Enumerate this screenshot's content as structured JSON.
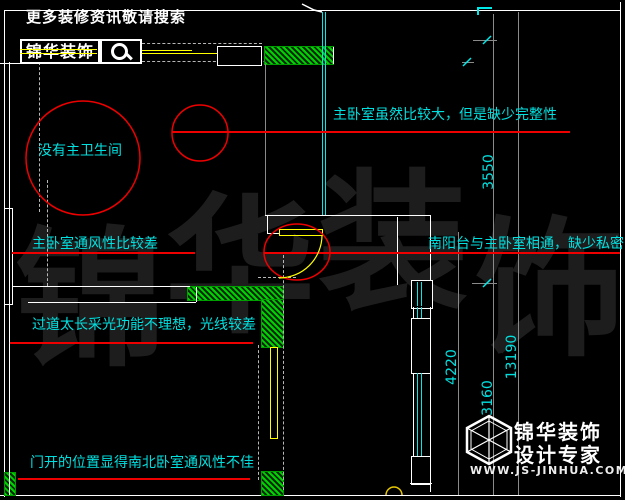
{
  "header": {
    "promo_text": "更多装修资讯敬请搜索",
    "brand_name": "锦华装饰",
    "search_icon": "magnifier-icon"
  },
  "annotations": [
    {
      "text": "没有主卫生间"
    },
    {
      "text": "主卧室虽然比较大，但是缺少完整性"
    },
    {
      "text": "主卧室通风性比较差"
    },
    {
      "text": "南阳台与主卧室相通，缺少私密"
    },
    {
      "text": "过道太长采光功能不理想，光线较差"
    },
    {
      "text": "门开的位置显得南北卧室通风性不佳"
    }
  ],
  "dimensions": [
    "3550",
    "4220",
    "13190",
    "3160"
  ],
  "watermark": [
    "锦",
    "华",
    "装",
    "饰"
  ],
  "footer": {
    "brand": "锦华装饰",
    "tagline": "设计专家",
    "website": "WWW.JS-JINHUA.COM",
    "logo_icon": "cube-wireframe-icon"
  },
  "colors": {
    "annotation_cyan": "#00e0e0",
    "highlight_red": "#ee0000",
    "hatch_green": "#00d400",
    "door_yellow": "#ffff00",
    "dimension_gray": "#8a8a8a",
    "background": "#000000"
  }
}
